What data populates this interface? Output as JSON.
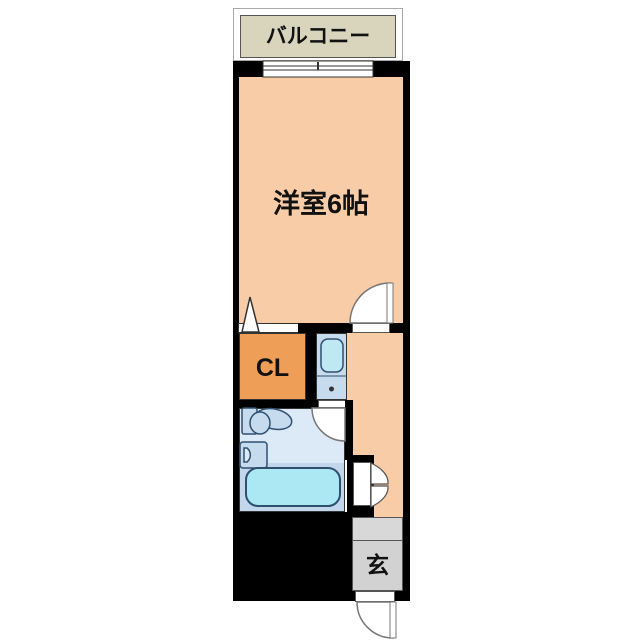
{
  "floorplan": {
    "balcony": {
      "label": "バルコニー"
    },
    "main_room": {
      "label": "洋室6帖"
    },
    "closet": {
      "label": "CL"
    },
    "entrance": {
      "label": "玄"
    },
    "colors": {
      "wall": "#000000",
      "room_floor": "#F8CCA6",
      "closet_floor": "#EF9E58",
      "balcony_floor": "#D9D5BC",
      "bathroom_upper": "#DCE9F6",
      "bathroom_lower": "#C3D7EC",
      "bathtub_fill": "#ACE8F3",
      "fixture_fill": "#C7DBEF",
      "sink_pan_fill": "#BFE9F2",
      "fixture_outline": "#2F4F6F",
      "entrance_floor": "#D2D2D2",
      "door_outline": "#777777"
    },
    "fixtures": [
      "sliding-window",
      "closet-folding-door",
      "room-door",
      "kitchen-sink-unit",
      "bathroom-door",
      "toilet",
      "washbasin",
      "bathtub",
      "storage-folding-door",
      "entrance-door"
    ]
  }
}
